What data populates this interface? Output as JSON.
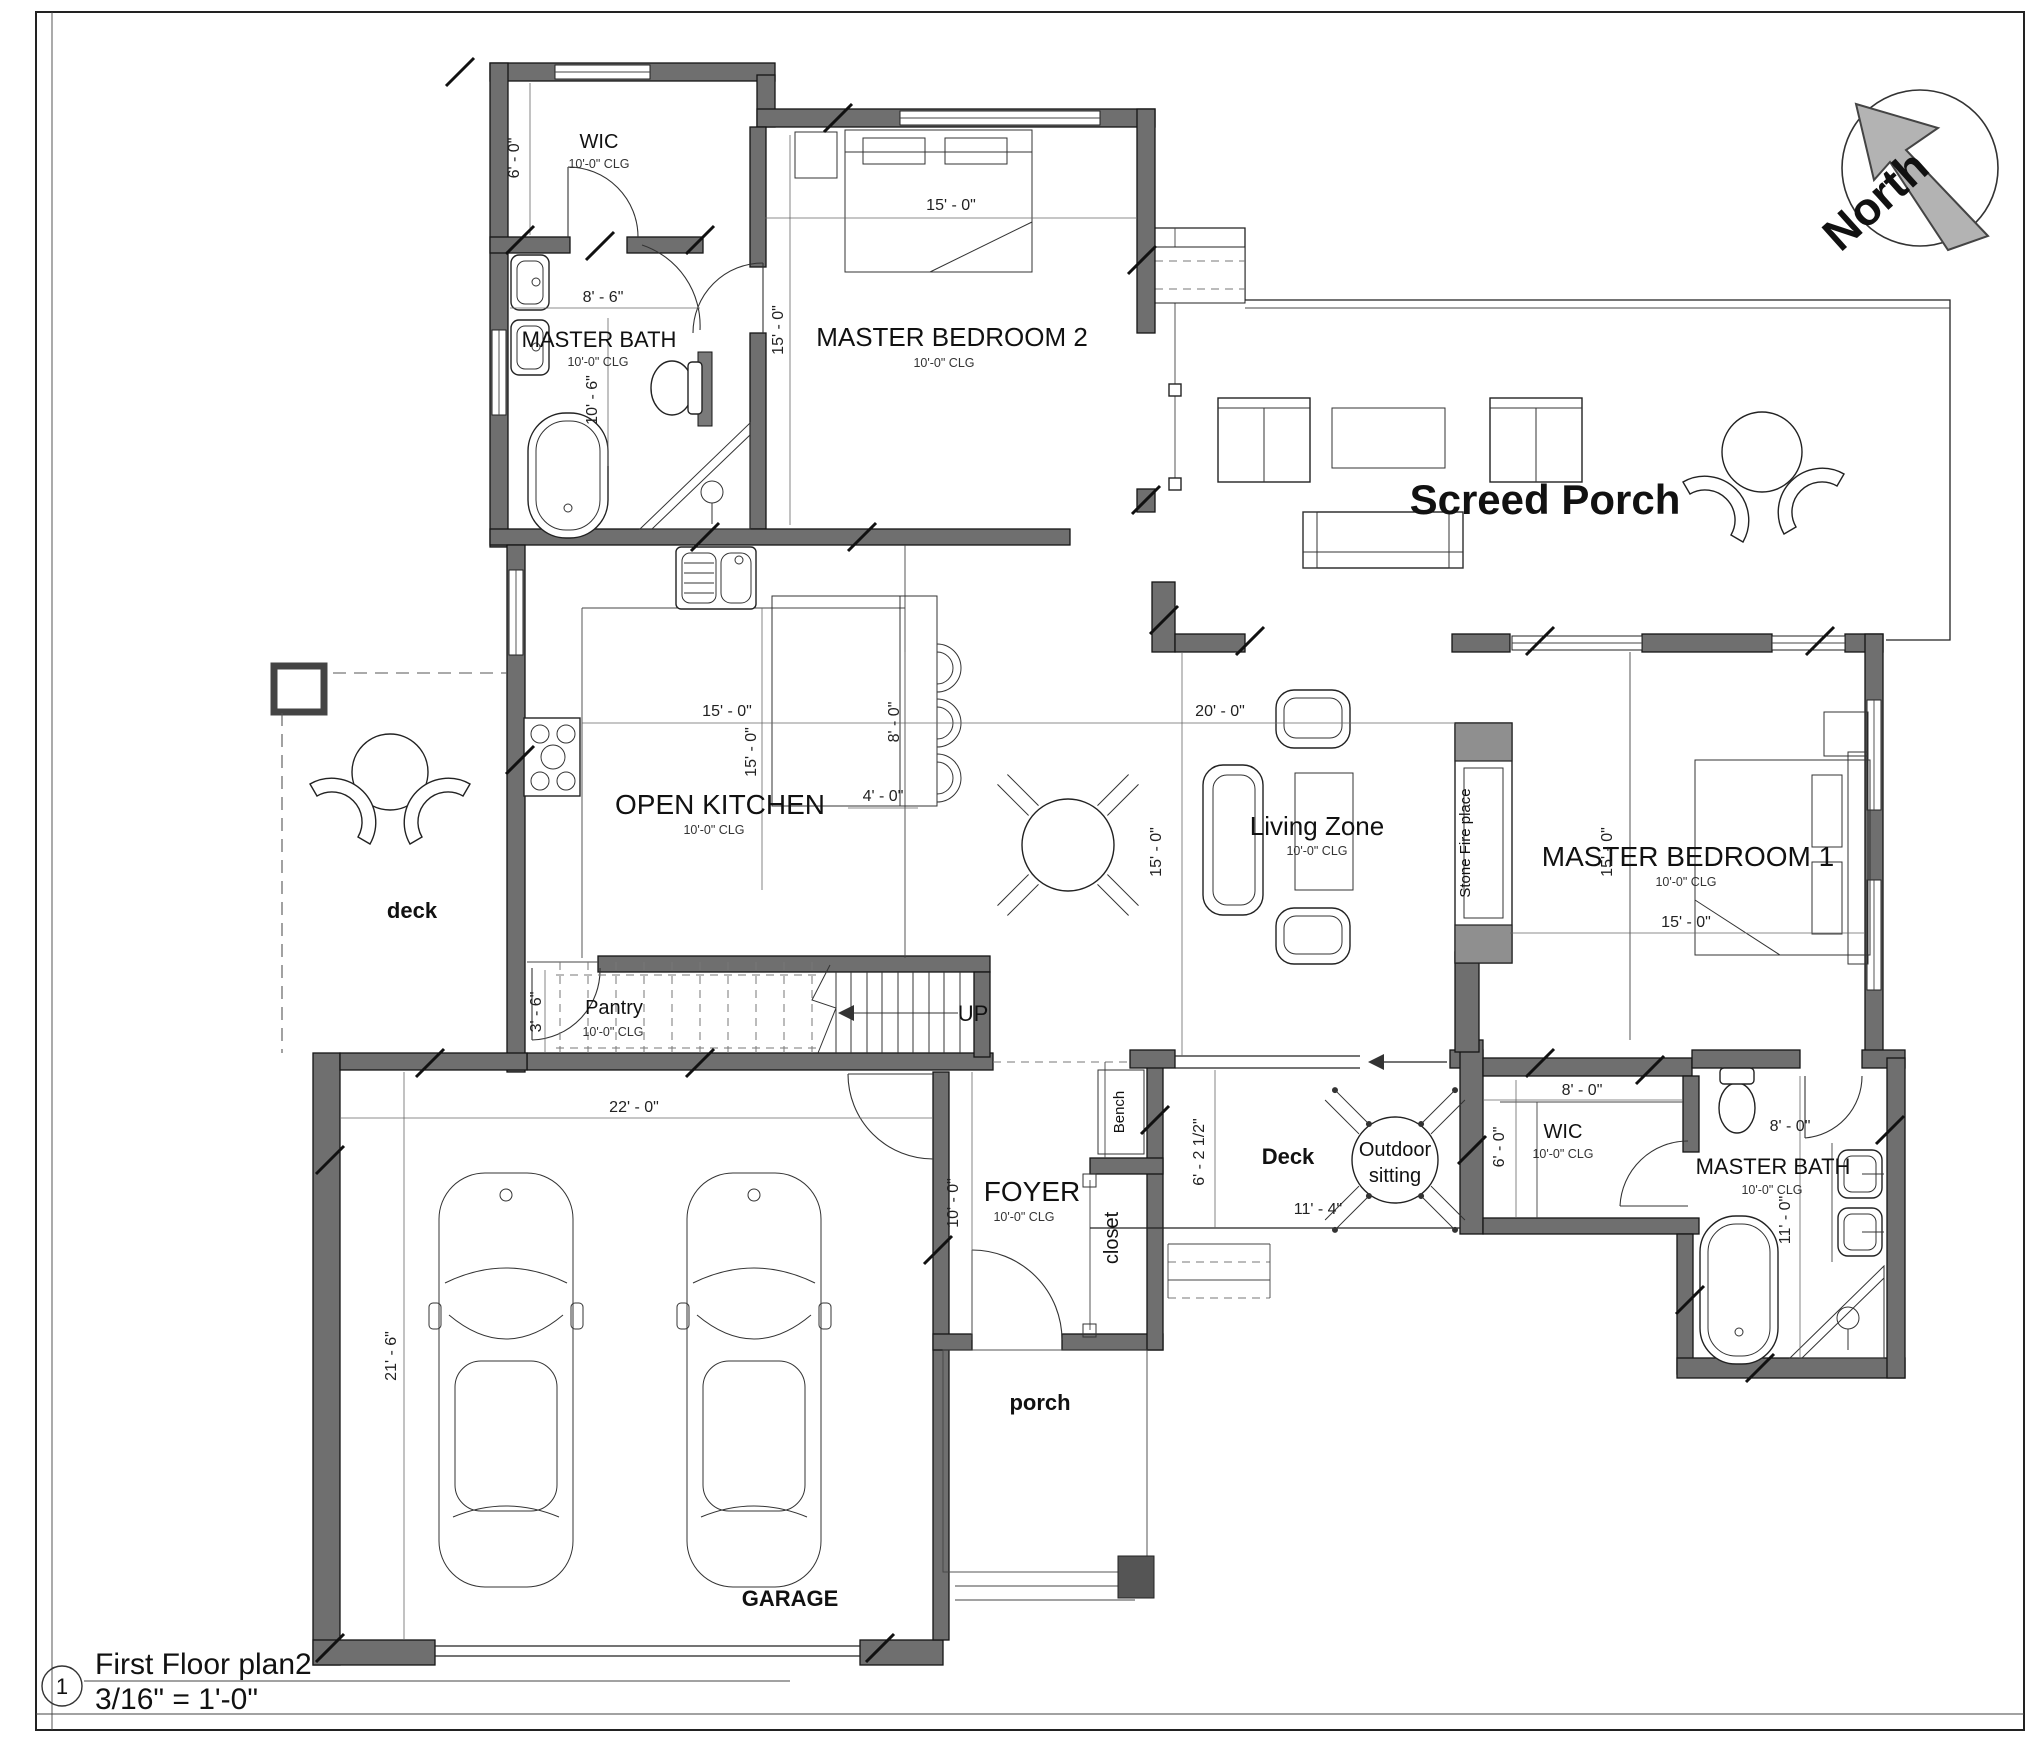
{
  "page": {
    "sheet_number": "1",
    "title": "First Floor plan2",
    "scale": "3/16\" = 1'-0\"",
    "north_label": "North"
  },
  "colors": {
    "paper": "#ffffff",
    "wall_fill": "#6f6f6f",
    "line": "#1a1a1a",
    "window_gray": "#8f8f8f",
    "north_arrow_fill": "#b3b3b3"
  },
  "rooms": {
    "wic_upper": {
      "label": "WIC",
      "clg": "10'-0\" CLG"
    },
    "master_bath_upper": {
      "label": "MASTER BATH",
      "clg": "10'-0\" CLG"
    },
    "master_bedroom_2": {
      "label": "MASTER BEDROOM 2",
      "clg": "10'-0\" CLG"
    },
    "screed_porch": {
      "label": "Screed Porch"
    },
    "open_kitchen": {
      "label": "OPEN KITCHEN",
      "clg": "10'-0\" CLG"
    },
    "deck_left": {
      "label": "deck"
    },
    "pantry": {
      "label": "Pantry",
      "clg": "10'-0\" CLG"
    },
    "stairs": {
      "label": "UP"
    },
    "living_zone": {
      "label": "Living Zone",
      "clg": "10'-0\" CLG"
    },
    "fireplace": {
      "label": "Stone Fire place"
    },
    "master_bedroom_1": {
      "label": "MASTER BEDROOM 1",
      "clg": "10'-0\" CLG"
    },
    "foyer": {
      "label": "FOYER",
      "clg": "10'-0\" CLG"
    },
    "bench": {
      "label": "Bench"
    },
    "closet": {
      "label": "closet"
    },
    "deck_rear": {
      "label": "Deck"
    },
    "outdoor_sitting": {
      "line1": "Outdoor",
      "line2": "sitting"
    },
    "wic_lower": {
      "label": "WIC",
      "clg": "10'-0\" CLG"
    },
    "master_bath_lower": {
      "label": "MASTER BATH",
      "clg": "10'-0\" CLG"
    },
    "garage": {
      "label": "GARAGE"
    },
    "porch": {
      "label": "porch"
    }
  },
  "dimensions": {
    "wic_upper_depth": "6' - 0\"",
    "bath_upper_width": "8' - 6\"",
    "bath_upper_depth": "10' - 6\"",
    "mb2_width": "15' - 0\"",
    "mb2_depth": "15' - 0\"",
    "kitchen_width": "15' - 0\"",
    "kitchen_depth": "15' - 0\"",
    "island_width": "4' - 0\"",
    "island_depth": "8' - 0\"",
    "living_width": "20' - 0\"",
    "living_depth": "15' - 0\"",
    "mb1_depth": "15' - 0\"",
    "mb1_width": "15' - 0\"",
    "pantry_width": "3' - 6\"",
    "garage_width": "22' - 0\"",
    "garage_depth": "21' - 6\"",
    "foyer_depth": "10' - 0\"",
    "deck_rear_depth": "6' - 2 1/2\"",
    "deck_rear_width": "11' - 4\"",
    "wic_lower_width": "8' - 0\"",
    "wic_lower_depth": "6' - 0\"",
    "bath_lower_width": "8' - 0\"",
    "bath_lower_depth": "11' - 0\""
  }
}
